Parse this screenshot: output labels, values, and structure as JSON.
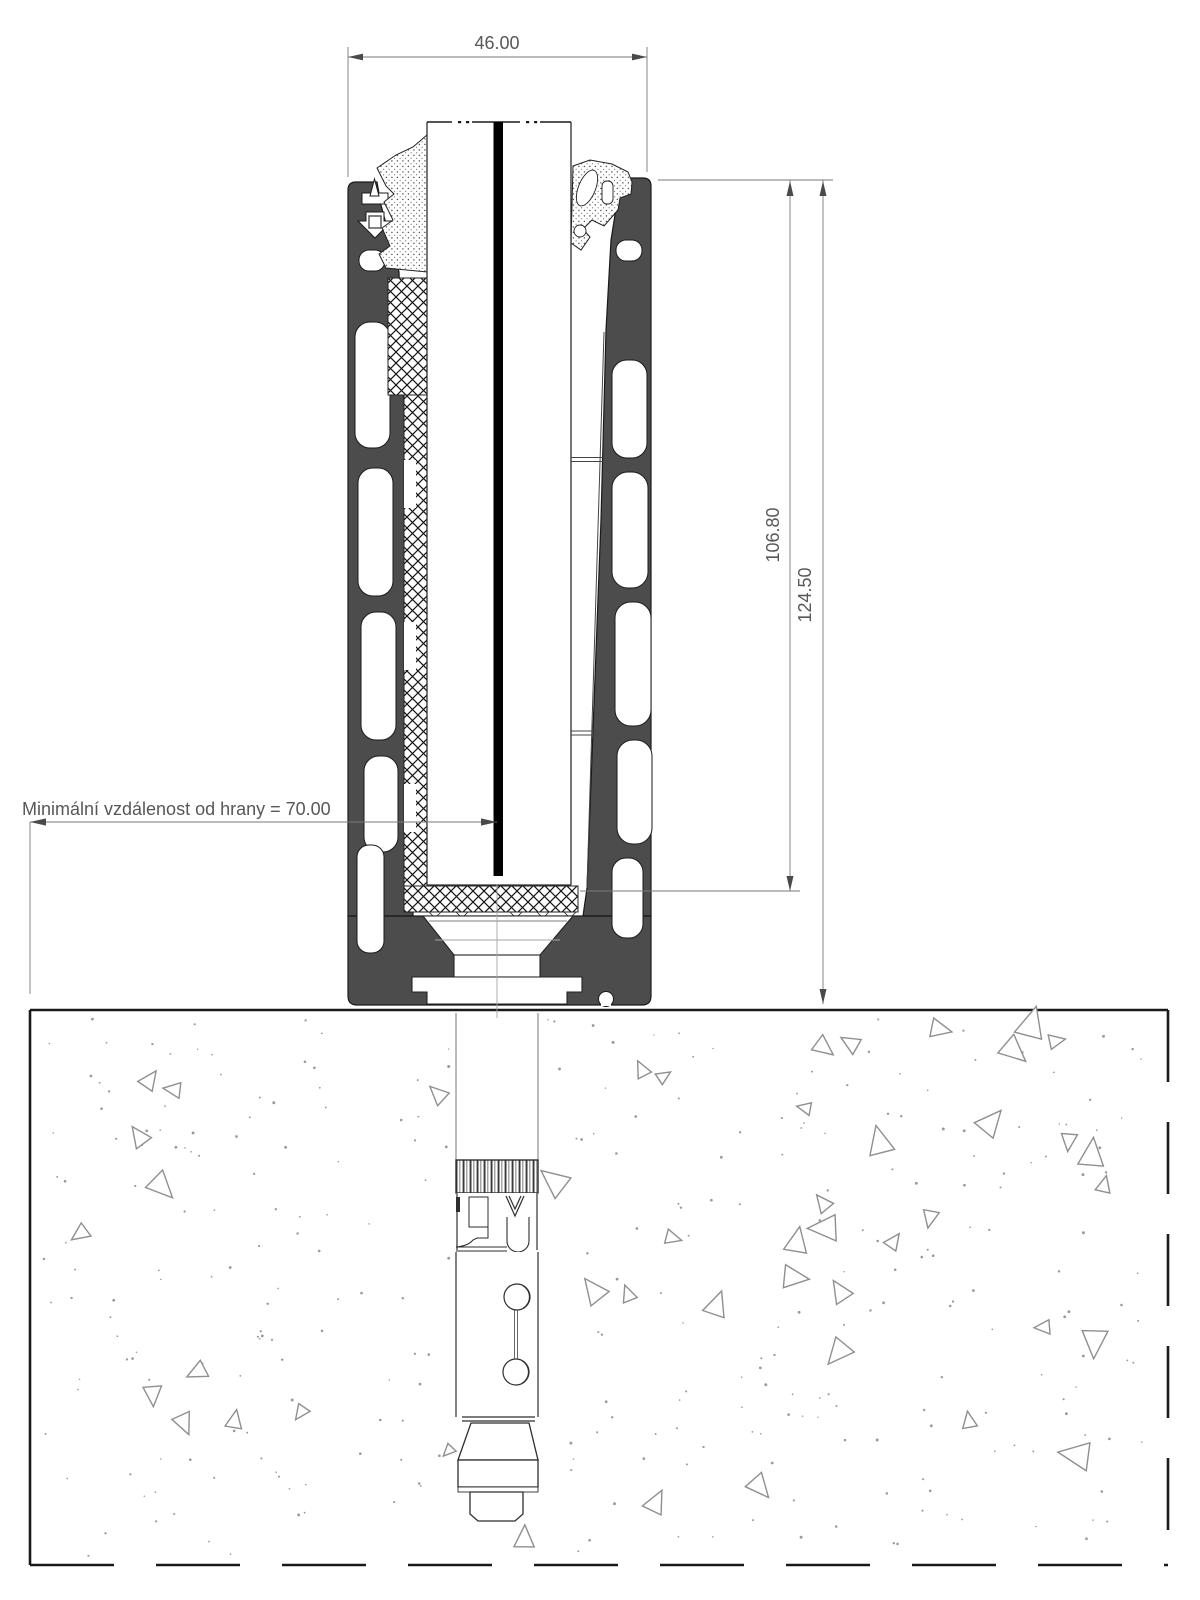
{
  "drawing": {
    "kind": "technical-section-drawing",
    "dimensions": {
      "top_width": "46.00",
      "profile_height": "106.80",
      "total_height": "124.50"
    },
    "note_left": "Minimální vzdálenost od hrany = 70.00",
    "colors": {
      "profile": "#4c4c4c",
      "outline": "#1a1a1a",
      "dimension_line": "#7a7a7a",
      "dimension_text": "#575757",
      "concrete_texture": "#8f8f8f",
      "glass_interlayer": "#000000",
      "background": "#ffffff"
    },
    "texture": {
      "seed": 9,
      "dots": 300,
      "triangles": 46
    }
  }
}
